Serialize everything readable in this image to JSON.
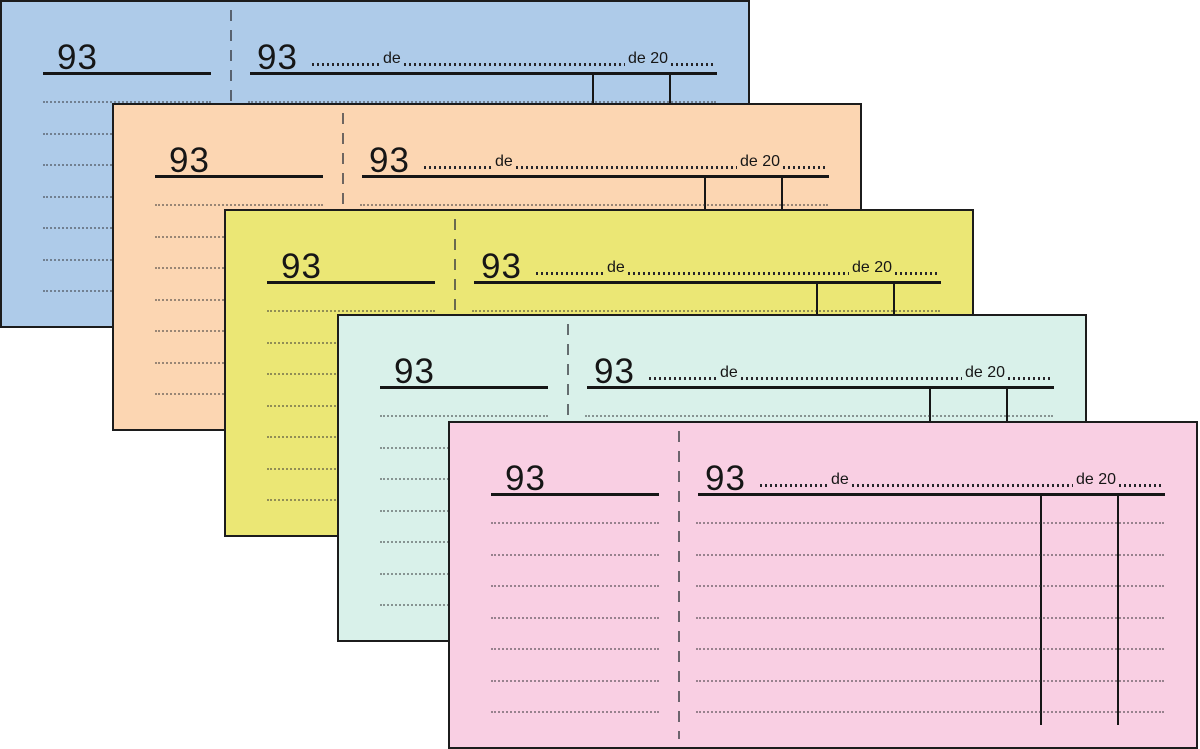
{
  "labels": {
    "de": "de",
    "de_20": "de 20"
  },
  "colors": {
    "ink": "#1c1c1c",
    "page_background": "#ffffff"
  },
  "forms": [
    {
      "paper_color": "#aecbe9",
      "stub_number": "93",
      "main_number": "93"
    },
    {
      "paper_color": "#fcd6b2",
      "stub_number": "93",
      "main_number": "93"
    },
    {
      "paper_color": "#ebe775",
      "stub_number": "93",
      "main_number": "93"
    },
    {
      "paper_color": "#d9f1ea",
      "stub_number": "93",
      "main_number": "93"
    },
    {
      "paper_color": "#f9cfe3",
      "stub_number": "93",
      "main_number": "93"
    }
  ]
}
